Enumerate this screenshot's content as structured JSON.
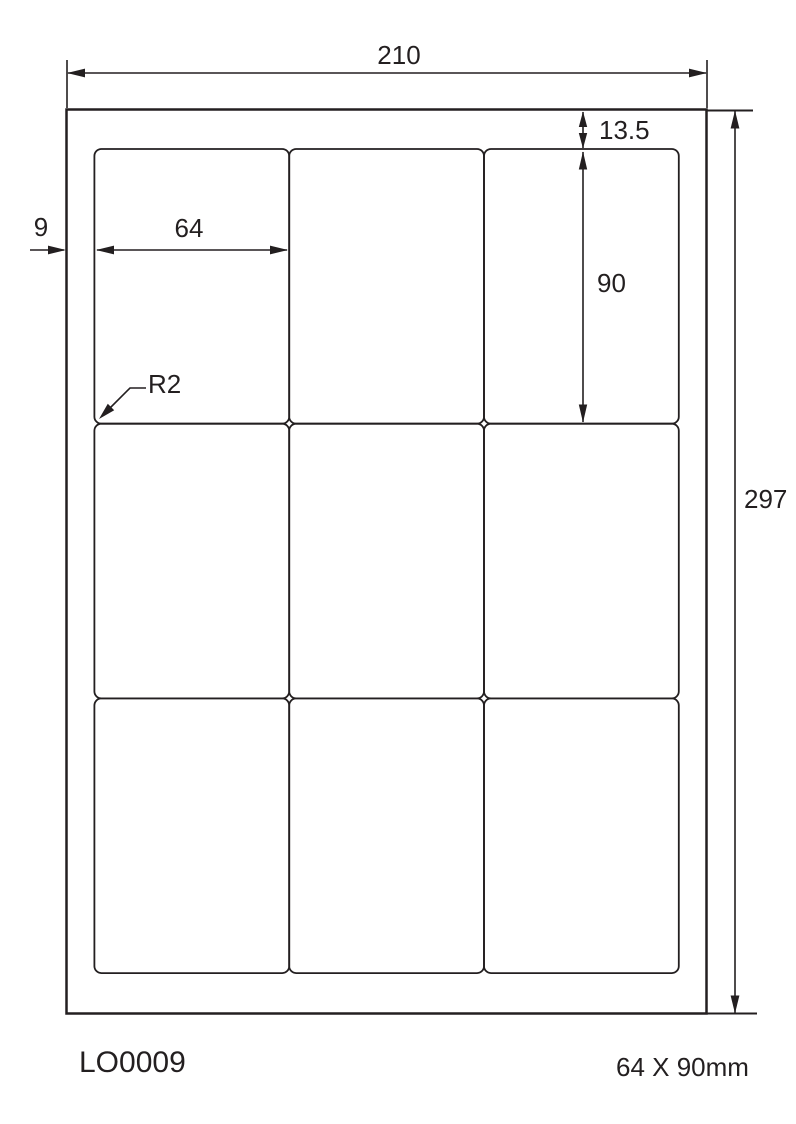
{
  "diagram": {
    "product_code": "LO0009",
    "label_size_caption": "64 X 90mm",
    "dims": {
      "page_width_mm": "210",
      "page_height_mm": "297",
      "top_margin_mm": "13.5",
      "label_height_mm": "90",
      "label_width_mm": "64",
      "left_margin_mm": "9",
      "corner_radius": "R2"
    },
    "grid": {
      "rows": 3,
      "columns": 3,
      "label_count": 9
    },
    "colors": {
      "line": "#231f20",
      "background": "#ffffff"
    }
  }
}
